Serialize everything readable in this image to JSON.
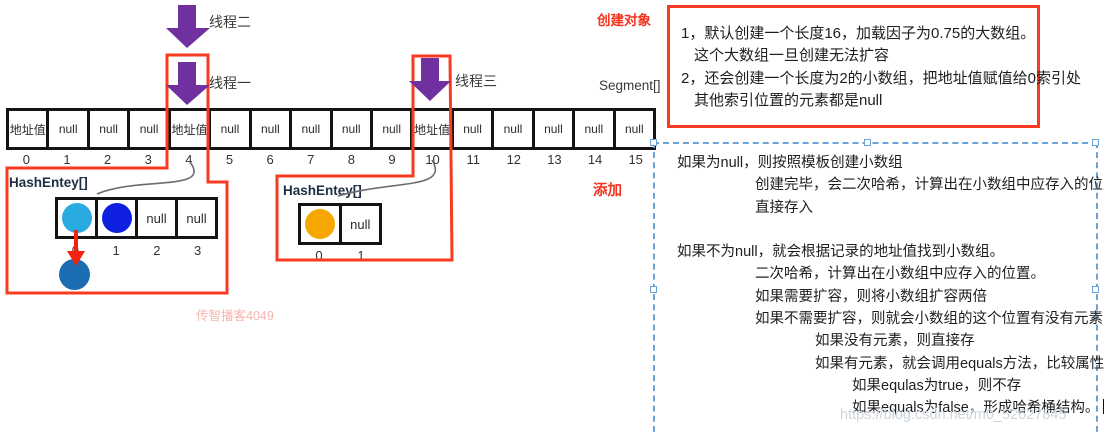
{
  "palette": {
    "highlight_red": "#f83a20",
    "arrow_purple": "#7030a0",
    "selection_blue": "#6aa3d8",
    "entry_cyan": "#29abe2",
    "entry_blue": "#0f1fe0",
    "entry_steel_blue": "#1b6cb0",
    "entry_orange": "#f7a800",
    "red_text": "#f4321e",
    "watermark_gray": "#ccd6de",
    "watermark_pink": "#f5b6b0"
  },
  "top_labels": {
    "thread2": "线程二",
    "thread1": "线程一",
    "thread3": "线程三",
    "create_object": "创建对象",
    "segment": "Segment[]",
    "add": "添加"
  },
  "segment_array": {
    "values": [
      "地址值",
      "null",
      "null",
      "null",
      "地址值",
      "null",
      "null",
      "null",
      "null",
      "null",
      "地址值",
      "null",
      "null",
      "null",
      "null",
      "null"
    ],
    "indices": [
      "0",
      "1",
      "2",
      "3",
      "4",
      "5",
      "6",
      "7",
      "8",
      "9",
      "10",
      "11",
      "12",
      "13",
      "14",
      "15"
    ]
  },
  "left_hash": {
    "label": "HashEntey[]",
    "cells": [
      {
        "circle": "#29abe2"
      },
      {
        "circle": "#0f1fe0"
      },
      {
        "text": "null"
      },
      {
        "text": "null"
      }
    ],
    "indices": [
      "0",
      "1",
      "2",
      "3"
    ],
    "detached_circle_color": "#1b6cb0"
  },
  "right_hash": {
    "label": "HashEntey[]",
    "cells": [
      {
        "circle": "#f7a800"
      },
      {
        "text": "null"
      }
    ],
    "indices": [
      "0",
      "1"
    ]
  },
  "notes_box": {
    "lines": [
      {
        "text": "1，默认创建一个长度16，加载因子为0.75的大数组。",
        "indent": 0
      },
      {
        "text": "这个大数组一旦创建无法扩容",
        "indent": 1
      },
      {
        "text": "2，还会创建一个长度为2的小数组，把地址值赋值给0索引处",
        "indent": 0
      },
      {
        "text": "其他索引位置的元素都是null",
        "indent": 1
      }
    ]
  },
  "flow_notes": {
    "lines": [
      {
        "text": "如果为null，则按照模板创建小数组",
        "indent": 0
      },
      {
        "text": "创建完毕，会二次哈希，计算出在小数组中应存入的位置。",
        "indent": 1
      },
      {
        "text": "直接存入",
        "indent": 1
      },
      {
        "text": "",
        "indent": 0
      },
      {
        "text": "如果不为null，就会根据记录的地址值找到小数组。",
        "indent": 0
      },
      {
        "text": "二次哈希，计算出在小数组中应存入的位置。",
        "indent": 1
      },
      {
        "text": "如果需要扩容，则将小数组扩容两倍",
        "indent": 1
      },
      {
        "text": "如果不需要扩容，则就会小数组的这个位置有没有元素",
        "indent": 1
      },
      {
        "text": "如果没有元素，则直接存",
        "indent": 2
      },
      {
        "text": "如果有元素，就会调用equals方法，比较属性值",
        "indent": 2
      },
      {
        "text": "如果equlas为true，则不存",
        "indent": 3
      },
      {
        "text": "如果equals为false，形成哈希桶结构。",
        "indent": 3,
        "cursor": true
      }
    ]
  },
  "watermarks": {
    "pink": "传智播客4049",
    "url": "https://blog.csdn.net/m0_52627845"
  }
}
